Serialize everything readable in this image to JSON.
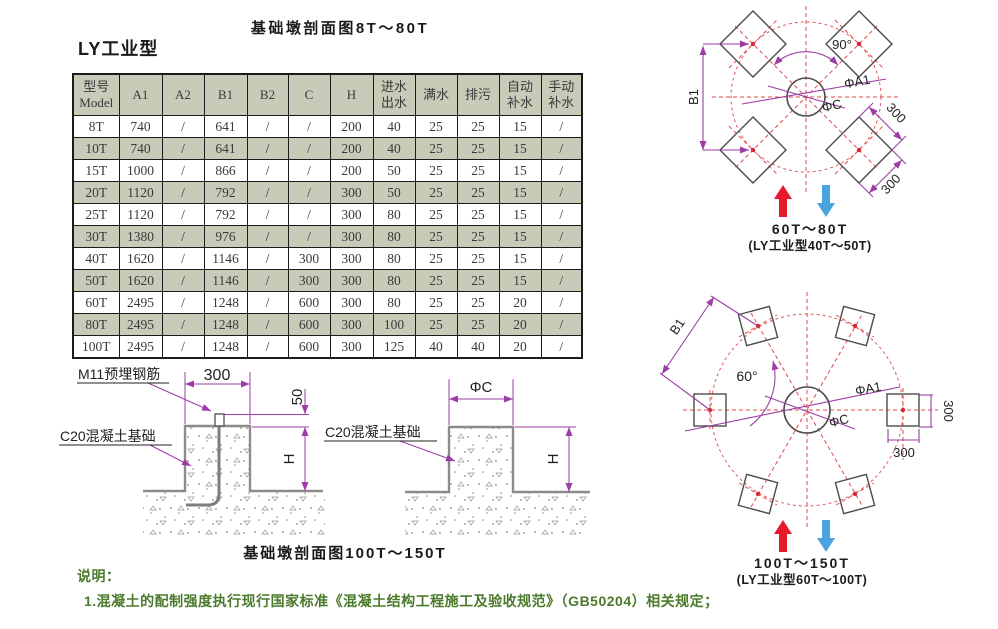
{
  "titles": {
    "top_caption": "基础墩剖面图8T～80T",
    "series_title": "LY工业型",
    "bottom_caption": "基础墩剖面图100T～150T"
  },
  "table": {
    "columns": [
      "型号\nModel",
      "A1",
      "A2",
      "B1",
      "B2",
      "C",
      "H",
      "进水\n出水",
      "满水",
      "排污",
      "自动\n补水",
      "手动\n补水"
    ],
    "rows": [
      [
        "8T",
        "740",
        "/",
        "641",
        "/",
        "/",
        "200",
        "40",
        "25",
        "25",
        "15",
        "/"
      ],
      [
        "10T",
        "740",
        "/",
        "641",
        "/",
        "/",
        "200",
        "40",
        "25",
        "25",
        "15",
        "/"
      ],
      [
        "15T",
        "1000",
        "/",
        "866",
        "/",
        "/",
        "200",
        "50",
        "25",
        "25",
        "15",
        "/"
      ],
      [
        "20T",
        "1120",
        "/",
        "792",
        "/",
        "/",
        "300",
        "50",
        "25",
        "25",
        "15",
        "/"
      ],
      [
        "25T",
        "1120",
        "/",
        "792",
        "/",
        "/",
        "300",
        "80",
        "25",
        "25",
        "15",
        "/"
      ],
      [
        "30T",
        "1380",
        "/",
        "976",
        "/",
        "/",
        "300",
        "80",
        "25",
        "25",
        "15",
        "/"
      ],
      [
        "40T",
        "1620",
        "/",
        "1146",
        "/",
        "300",
        "300",
        "80",
        "25",
        "25",
        "15",
        "/"
      ],
      [
        "50T",
        "1620",
        "/",
        "1146",
        "/",
        "300",
        "300",
        "80",
        "25",
        "25",
        "15",
        "/"
      ],
      [
        "60T",
        "2495",
        "/",
        "1248",
        "/",
        "600",
        "300",
        "80",
        "25",
        "25",
        "20",
        "/"
      ],
      [
        "80T",
        "2495",
        "/",
        "1248",
        "/",
        "600",
        "300",
        "100",
        "25",
        "25",
        "20",
        "/"
      ],
      [
        "100T",
        "2495",
        "/",
        "1248",
        "/",
        "600",
        "300",
        "125",
        "40",
        "40",
        "20",
        "/"
      ]
    ]
  },
  "section_left": {
    "rebar_label": "M11预埋钢筋",
    "width_dim": "300",
    "offset_dim": "50",
    "concrete_label": "C20混凝土基础",
    "height_dim": "H"
  },
  "section_right": {
    "width_dim": "ΦC",
    "concrete_label": "C20混凝土基础",
    "height_dim": "H"
  },
  "layout_top": {
    "angle": "90°",
    "dim_b1": "B1",
    "dim_a1": "ΦA1",
    "dim_c": "ΦC",
    "dim_300a": "300",
    "dim_300b": "300",
    "caption_line1": "60T～80T",
    "caption_line2": "(LY工业型40T～50T)"
  },
  "layout_bottom": {
    "angle": "60°",
    "dim_b1": "B1",
    "dim_a1": "ΦA1",
    "dim_c": "ΦC",
    "dim_300a": "300",
    "dim_300b": "300",
    "caption_line1": "100T～150T",
    "caption_line2": "(LY工业型60T～100T)"
  },
  "notes": {
    "heading": "说明：",
    "line1": "1.混凝土的配制强度执行现行国家标准《混凝土结构工程施工及验收规范》（GB50204）相关规定；"
  },
  "colors": {
    "table_shade": "#c9cab8",
    "dim_purple": "#9c3da5",
    "dash_red": "#e24848",
    "arrow_red": "#e8192d",
    "arrow_blue": "#4aa3de",
    "note_green": "#4b7a2b",
    "outline_gray": "#8c8c8c"
  }
}
